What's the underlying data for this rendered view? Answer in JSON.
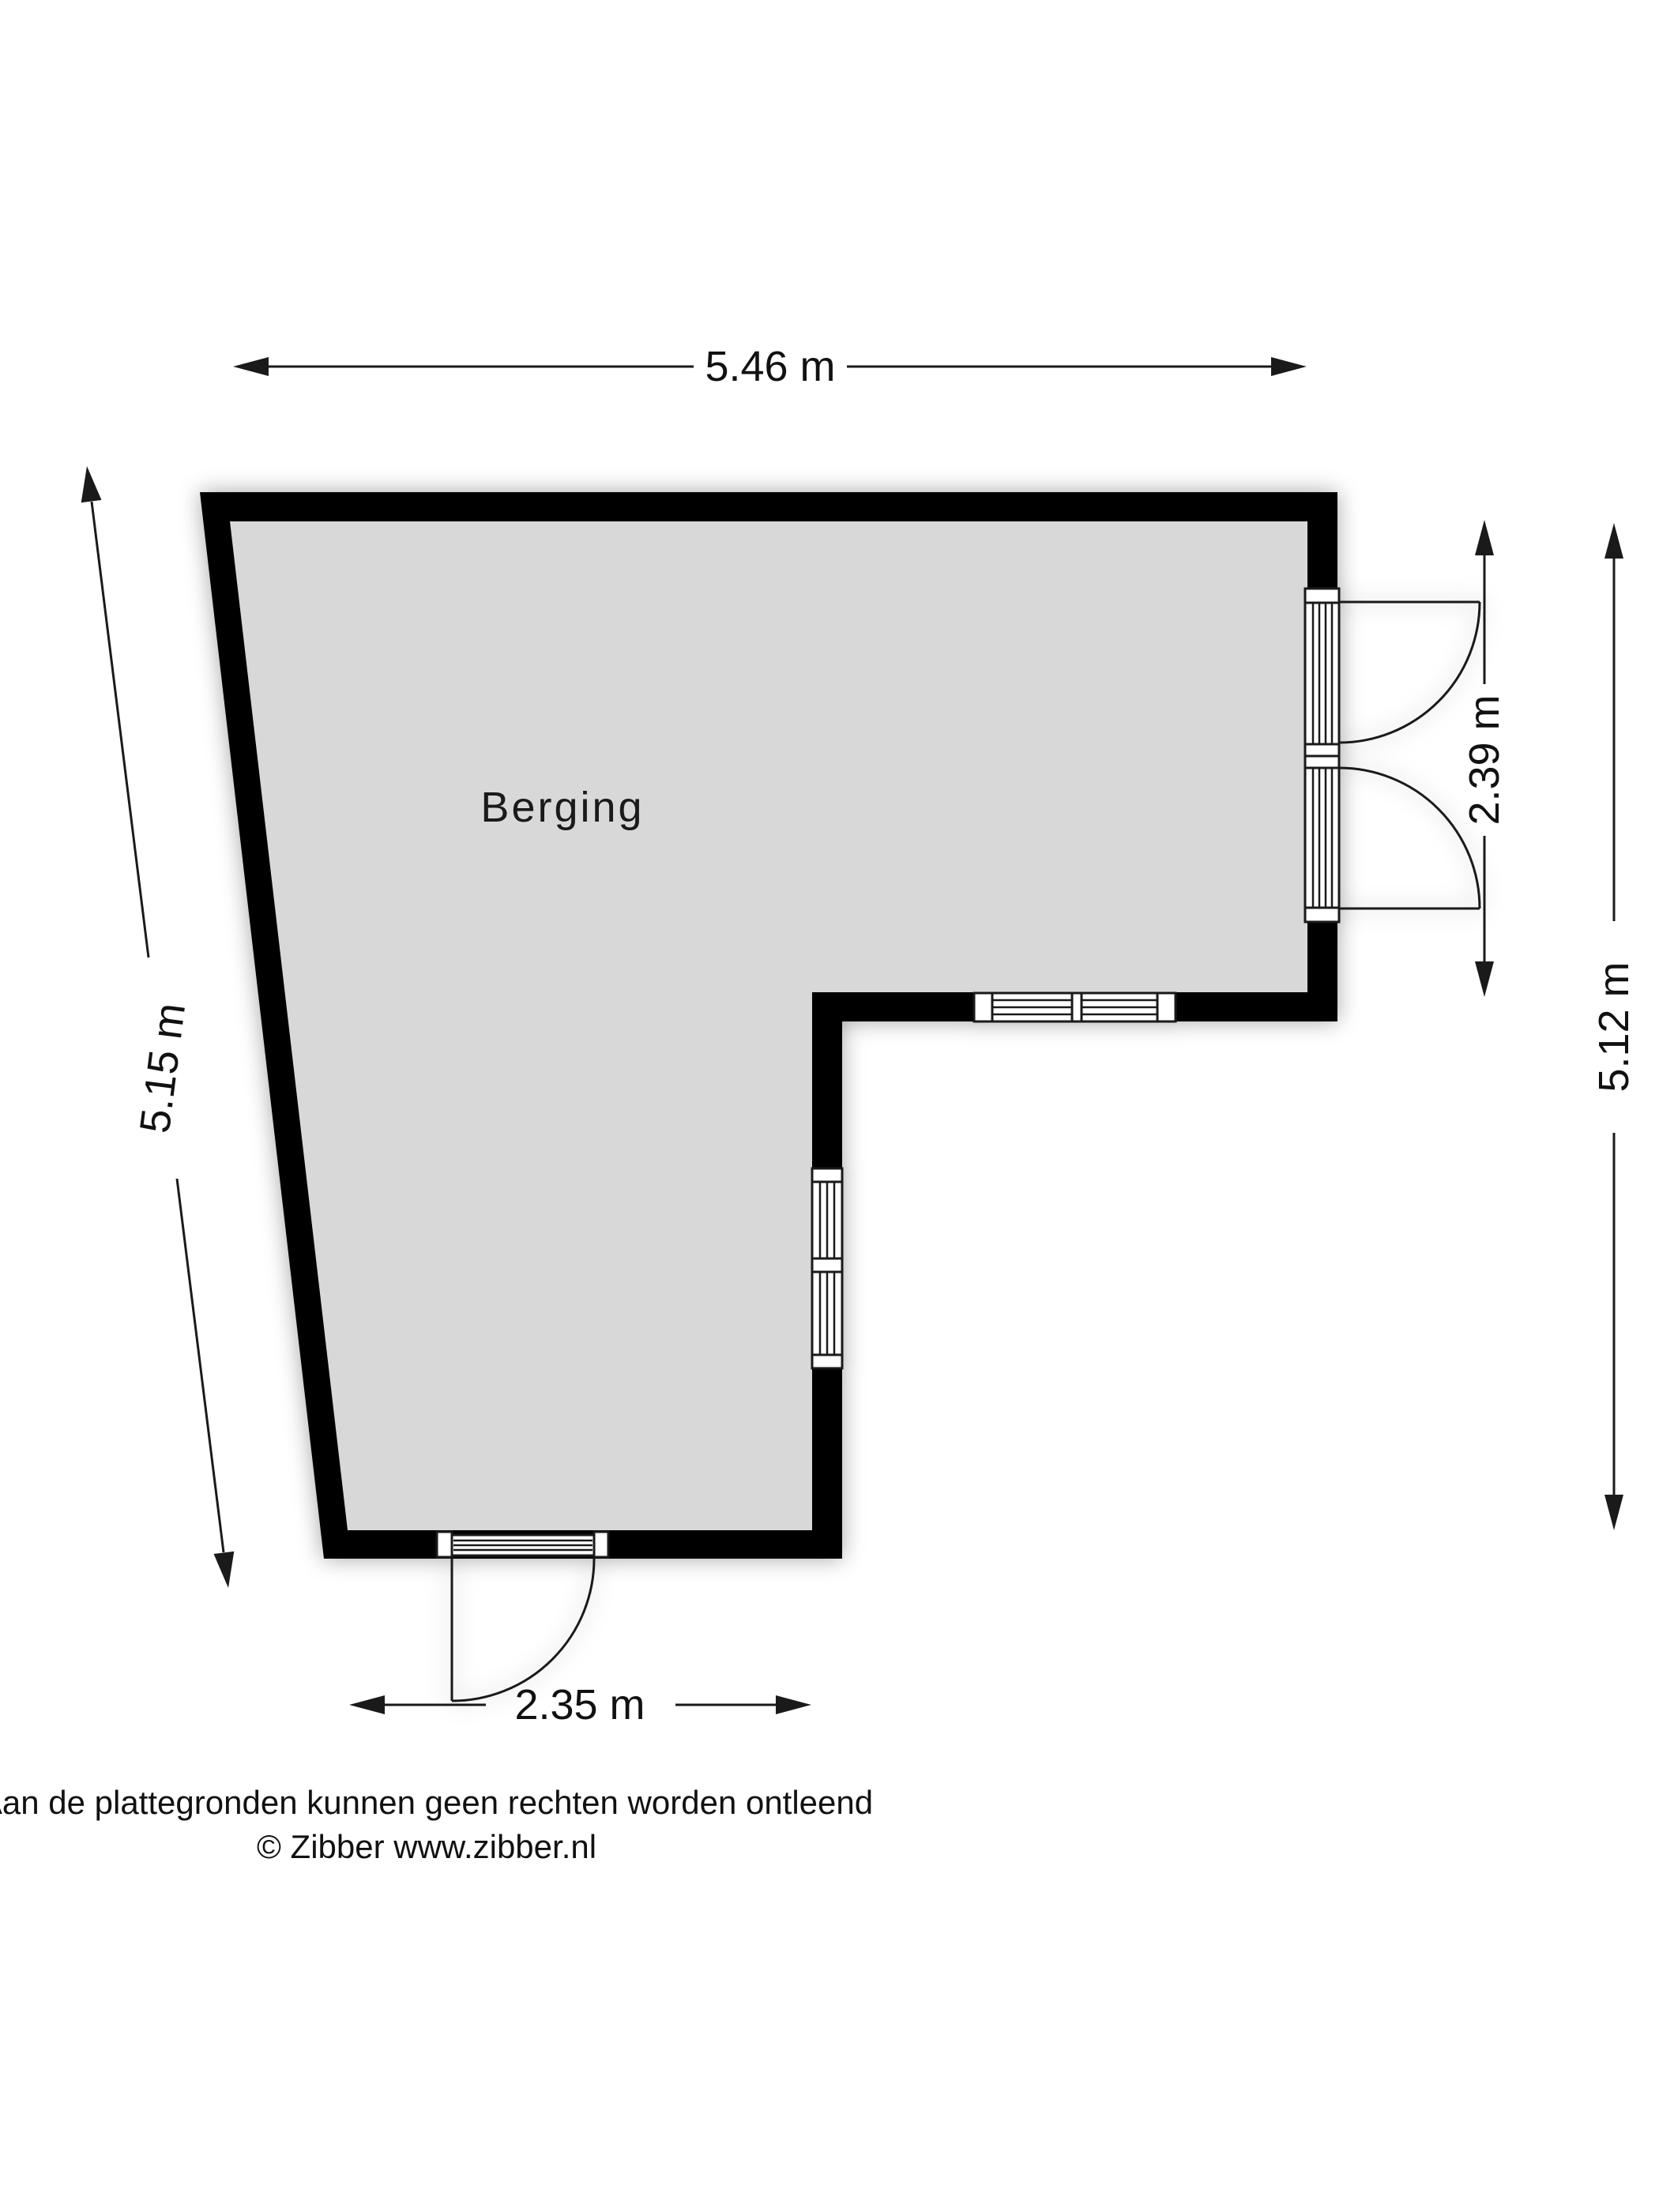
{
  "room": {
    "name": "Berging"
  },
  "dimensions": {
    "top": "5.46 m",
    "left": "5.15 m",
    "right_door_section": "2.39 m",
    "right_total": "5.12 m",
    "bottom": "2.35 m"
  },
  "footer": {
    "disclaimer": "Aan de plattegronden kunnen geen rechten worden ontleend",
    "copyright": "© Zibber www.zibber.nl"
  },
  "colors": {
    "wall": "#000000",
    "floor": "#d8d8d8",
    "line": "#1a1a1a",
    "background": "#ffffff"
  }
}
